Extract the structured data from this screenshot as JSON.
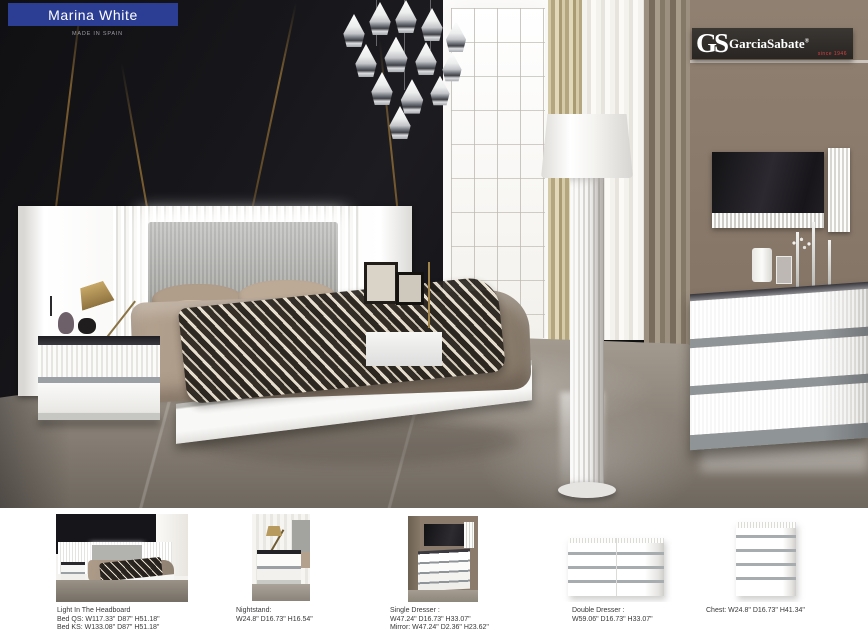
{
  "page": {
    "title": "Marina White",
    "made_in": "MADE IN SPAIN"
  },
  "brand": {
    "initials": "GS",
    "name": "GarciaSabate",
    "registered": "®",
    "since": "since 1946"
  },
  "colors": {
    "banner_blue": "#2c3d94",
    "logo_red": "#d84040",
    "marble_black": "#17171b",
    "wall_brown": "#8a7a6c",
    "accent_gray": "#9aa0a3"
  },
  "products": [
    {
      "id": "bed",
      "caption_lines": [
        "Light In The Headboard",
        "Bed QS: W117.33\" D87\" H51.18\"",
        "Bed KS: W133.08\" D87\" H51.18\""
      ]
    },
    {
      "id": "nightstand",
      "caption_lines": [
        "Nightstand:",
        "W24.8\" D16.73\" H16.54\""
      ]
    },
    {
      "id": "single-dresser",
      "caption_lines": [
        "Single Dresser :",
        "W47.24\" D16.73\" H33.07\"",
        "Mirror: W47.24\" D2.36\" H23.62\""
      ]
    },
    {
      "id": "double-dresser",
      "caption_lines": [
        "Double Dresser :",
        "W59.06\" D16.73\" H33.07\""
      ]
    },
    {
      "id": "chest",
      "caption_lines": [
        "Chest: W24.8\" D16.73\" H41.34\""
      ]
    }
  ]
}
